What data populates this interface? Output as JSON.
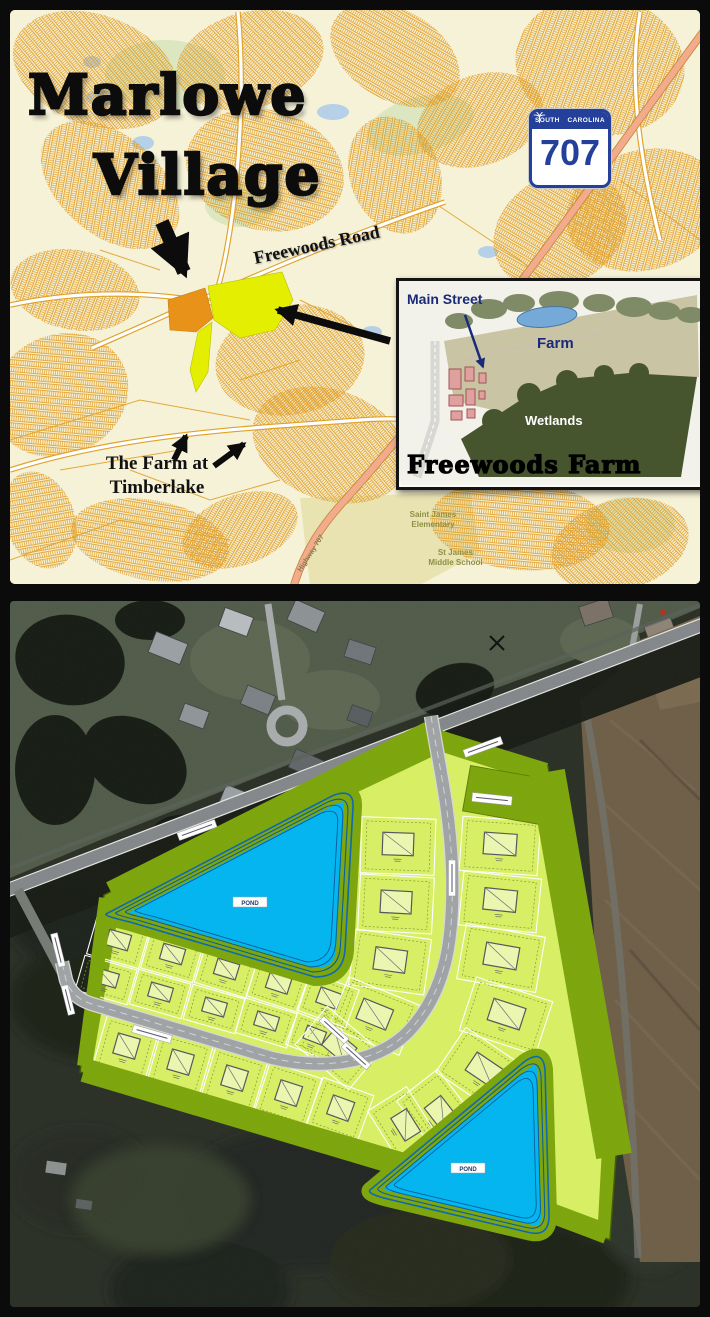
{
  "location_map": {
    "title": {
      "line1": "Marlowe",
      "line2": "Village"
    },
    "freewoods_road_label": "Freewoods Road",
    "timberlake_label": {
      "line1": "The Farm at",
      "line2": "Timberlake"
    },
    "route_shield": {
      "state_left": "SOUTH",
      "state_right": "CAROLINA",
      "route_number": "707"
    },
    "school_labels": {
      "elementary_line1": "Saint James",
      "elementary_line2": "Elementary",
      "middle_line1": "St James",
      "middle_line2": "Middle School"
    },
    "highway_label": "Highway 707",
    "inset": {
      "caption": "Freewoods Farm",
      "main_street_label": "Main Street",
      "farm_label": "Farm",
      "wetlands_label": "Wetlands"
    }
  },
  "site_plan": {
    "pond1_label": "POND",
    "pond2_label": "POND"
  },
  "colors": {
    "map_parcel_orange": "#E09A20",
    "highlight_parcel_orange": "#E8921A",
    "highlight_parcel_yellow": "#E4EE00",
    "plan_boundary_green": "#7CA50A",
    "lot_light_green": "#D8F063",
    "pond_cyan": "#00B5F0",
    "shield_navy": "#24409A"
  }
}
